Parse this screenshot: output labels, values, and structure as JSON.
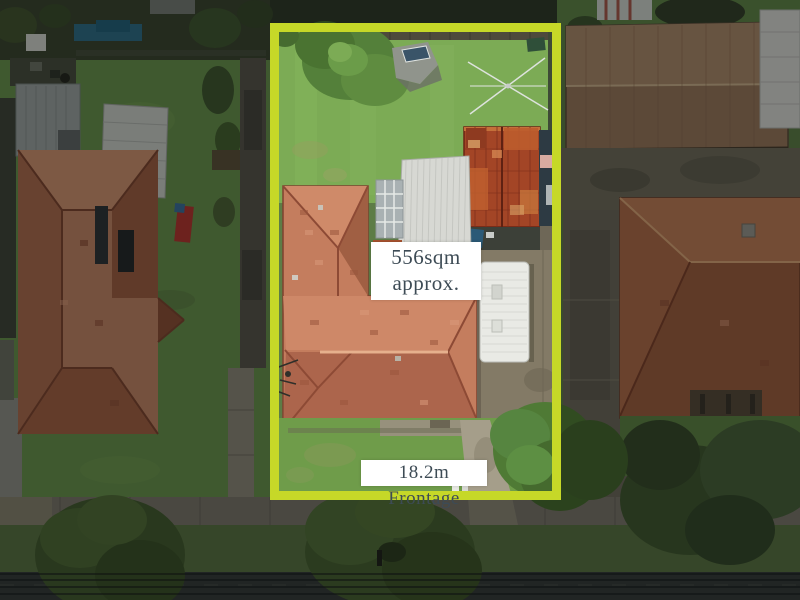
{
  "overlay": {
    "area_label": {
      "line1": "556sqm",
      "line2": "approx."
    },
    "frontage_label": "18.2m Frontage",
    "boundary_color": "#c6d828",
    "label_background": "#ffffff",
    "label_text_color": "#3d4b55"
  }
}
